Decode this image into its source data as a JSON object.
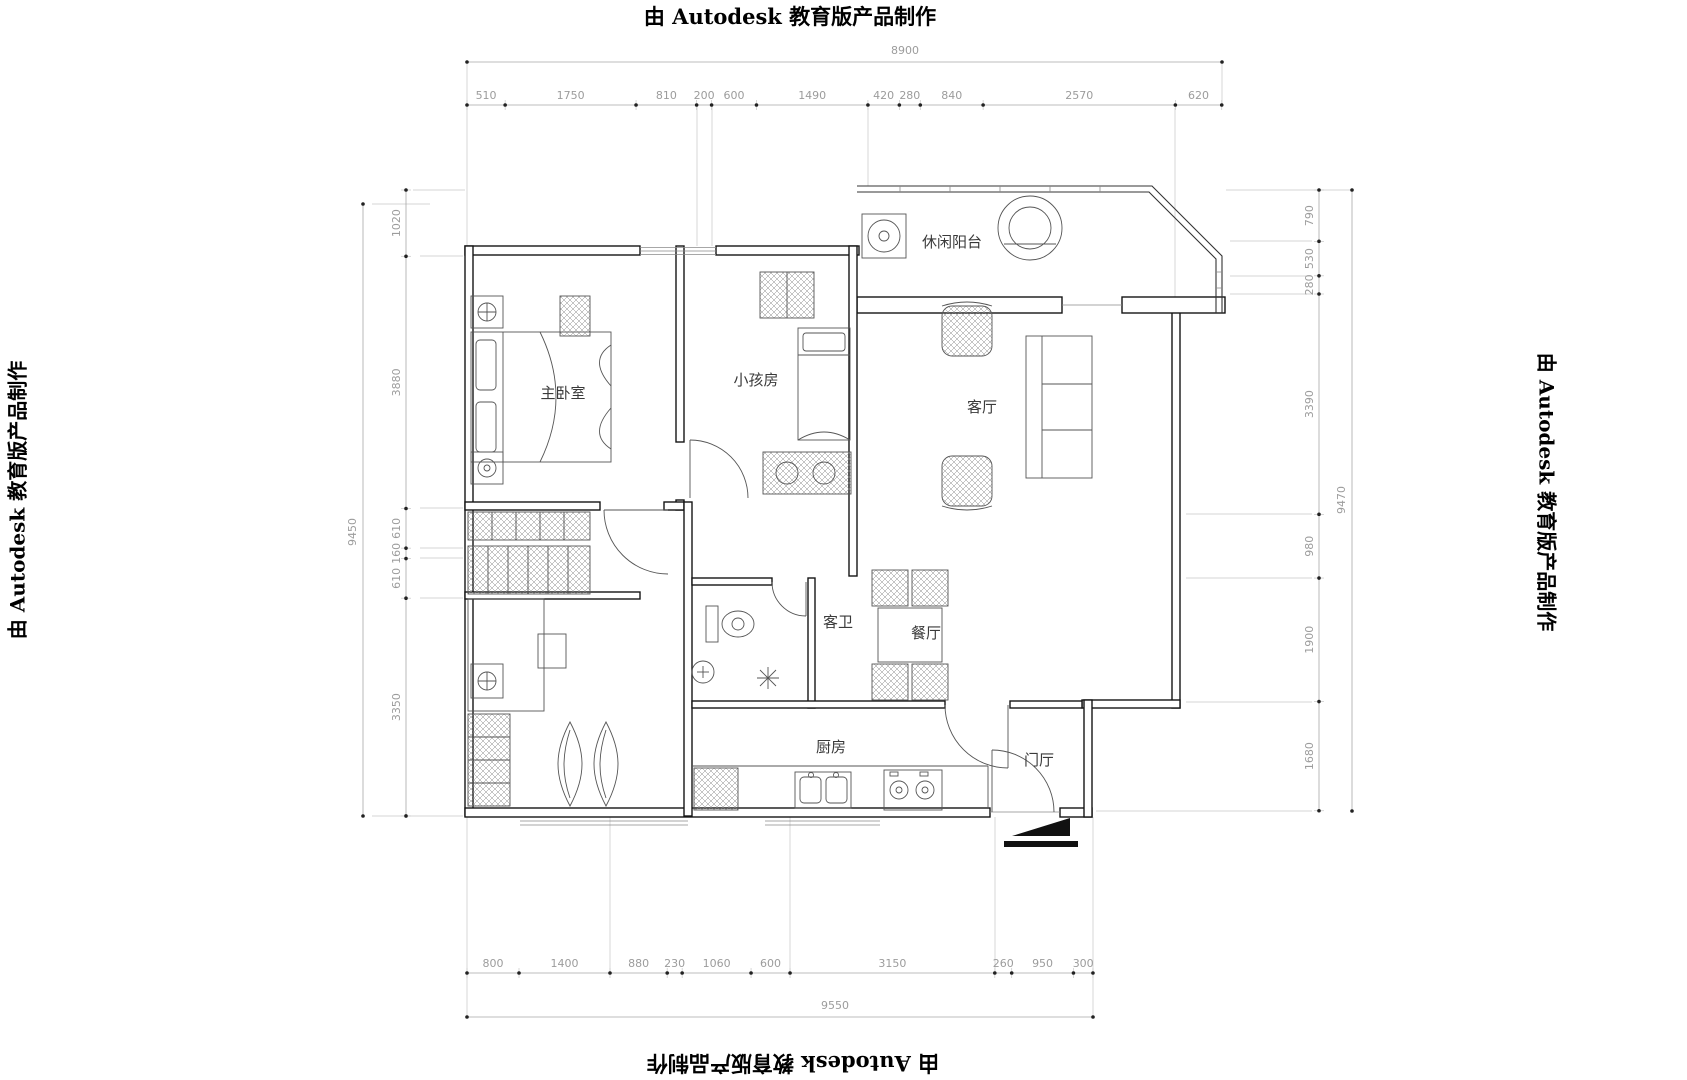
{
  "watermark": {
    "text": "由 Autodesk 教育版产品制作"
  },
  "rooms": {
    "master_bedroom": "主卧室",
    "kids_room": "小孩房",
    "leisure_balcony": "休闲阳台",
    "living_room": "客厅",
    "guest_bathroom": "客卫",
    "dining_room": "餐厅",
    "kitchen": "厨房",
    "foyer": "门厅"
  },
  "dimensions": {
    "top": {
      "overall": "8900",
      "segments": [
        "510",
        "1750",
        "810",
        "200",
        "600",
        "1490",
        "420",
        "280",
        "840",
        "2570",
        "620"
      ]
    },
    "bottom": {
      "overall": "9550",
      "segments": [
        "800",
        "1400",
        "880",
        "230",
        "1060",
        "600",
        "3150",
        "260",
        "950",
        "300"
      ]
    },
    "left": {
      "overall": "9450",
      "segments": [
        "1020",
        "3880",
        "610",
        "160",
        "610",
        "3350"
      ]
    },
    "right": {
      "overall": "9470",
      "segments": [
        "790",
        "530",
        "280",
        "3390",
        "980",
        "1900",
        "1680"
      ]
    }
  }
}
